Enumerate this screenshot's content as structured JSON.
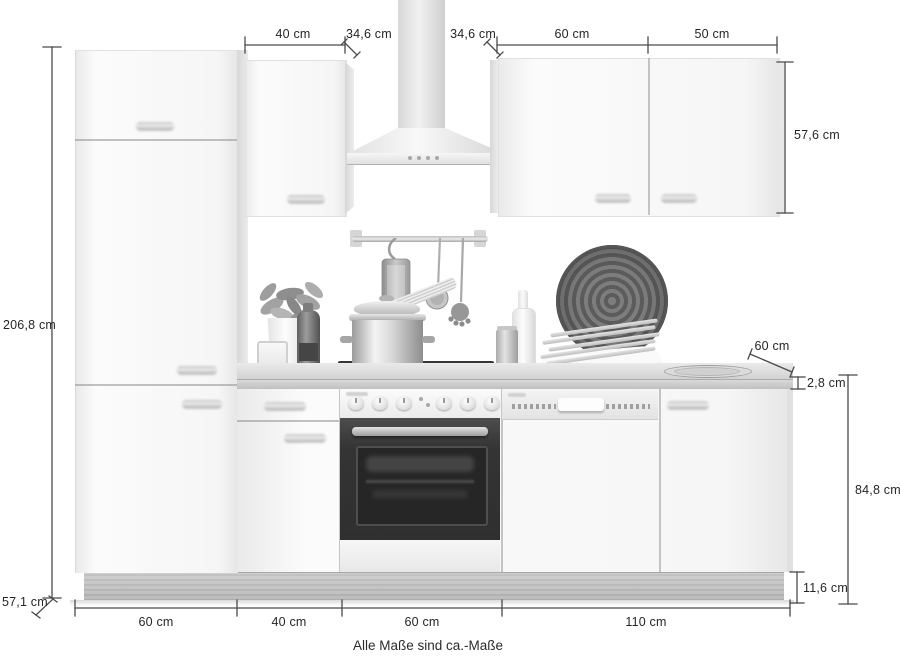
{
  "footer": {
    "note": "Alle Maße sind ca.-Maße"
  },
  "dims": {
    "tall_unit_height": "206,8 cm",
    "tall_unit_depth": "57,1 cm",
    "wall_cabinet_left_width": "40 cm",
    "wall_cabinet_left_depth": "34,6 cm",
    "wall_cabinet_right_depth": "34,6 cm",
    "wall_cabinet_right_width_1": "60 cm",
    "wall_cabinet_right_width_2": "50 cm",
    "wall_cabinet_height": "57,6 cm",
    "worktop_depth": "60 cm",
    "worktop_thickness": "2,8 cm",
    "base_unit_height": "84,8 cm",
    "plinth_height": "11,6 cm",
    "base_width_1": "60 cm",
    "base_width_2": "40 cm",
    "base_width_3": "60 cm",
    "base_width_4": "110 cm"
  },
  "colors": {
    "background": "#ffffff",
    "dimension_line": "#4a4a4a",
    "label_text": "#262626",
    "appliance_dark": "#333333"
  }
}
